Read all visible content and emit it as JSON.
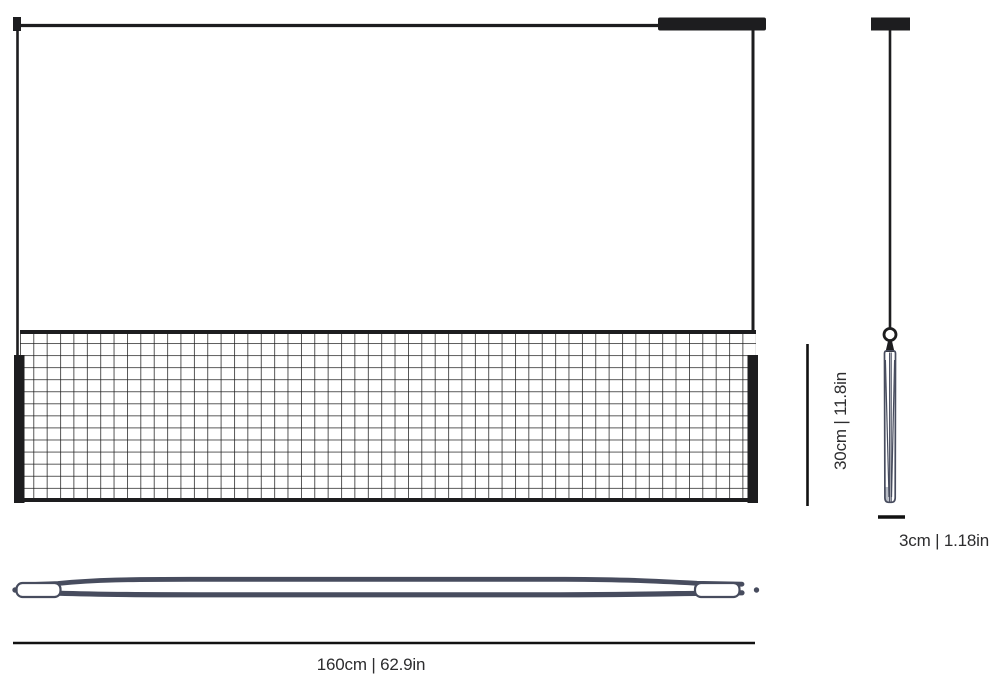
{
  "drawing": {
    "kind": "pendant-lamp-dimension-diagram",
    "views": {
      "front": "front-elevation-with-mesh-shade",
      "side": "side-profile-with-hanging-ring",
      "bottom": "bottom-profile-blade"
    }
  },
  "dimensions": {
    "height": {
      "label": "30cm | 11.8in"
    },
    "diameter": {
      "label": "3cm | 1.18in"
    },
    "width": {
      "label": "160cm | 62.9in"
    }
  },
  "colors": {
    "ink": "#1d1d1f",
    "mesh_line": "#1e1e1e",
    "steel_blue": "#474c5e",
    "cap_gray": "#b9bdc6",
    "label_text": "#2d2d2f"
  }
}
